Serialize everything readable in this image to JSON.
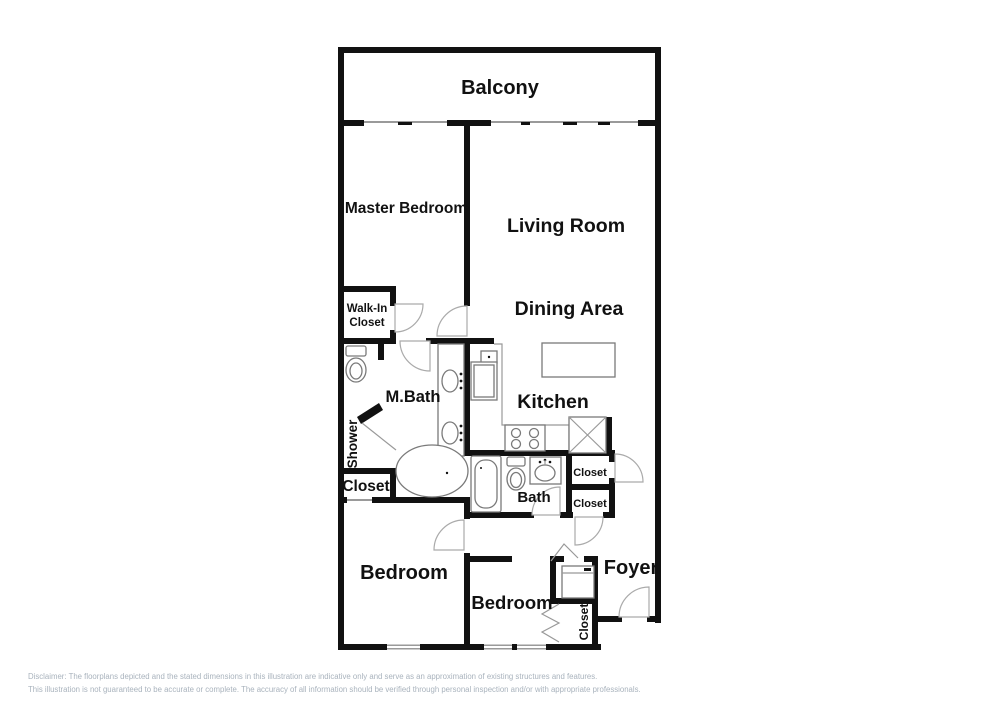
{
  "colors": {
    "background": "#ffffff",
    "wall": "#111111",
    "door_arc": "#aaaaaa",
    "fixture_outline": "#7a7a7a",
    "disclaimer_text": "#a9b3bd"
  },
  "rooms": {
    "balcony": "Balcony",
    "master_bedroom": "Master Bedroom",
    "living_room": "Living Room",
    "dining_area": "Dining Area",
    "walk_in_closet_line1": "Walk-In",
    "walk_in_closet_line2": "Closet",
    "m_bath": "M.Bath",
    "kitchen": "Kitchen",
    "shower": "Shower",
    "closet_master": "Closet",
    "bath": "Bath",
    "closet_hall_upper": "Closet",
    "closet_hall_lower": "Closet",
    "bedroom_left": "Bedroom",
    "bedroom_middle": "Bedroom",
    "foyer": "Foyer",
    "closet_entry": "Closet"
  },
  "disclaimer": {
    "line1": "Disclaimer: The floorplans depicted and the stated dimensions in this illustration are indicative only and serve as an approximation of existing structures and features.",
    "line2": "This illustration is not guaranteed to be accurate or complete. The accuracy of all information should be verified through personal inspection and/or with appropriate professionals."
  }
}
